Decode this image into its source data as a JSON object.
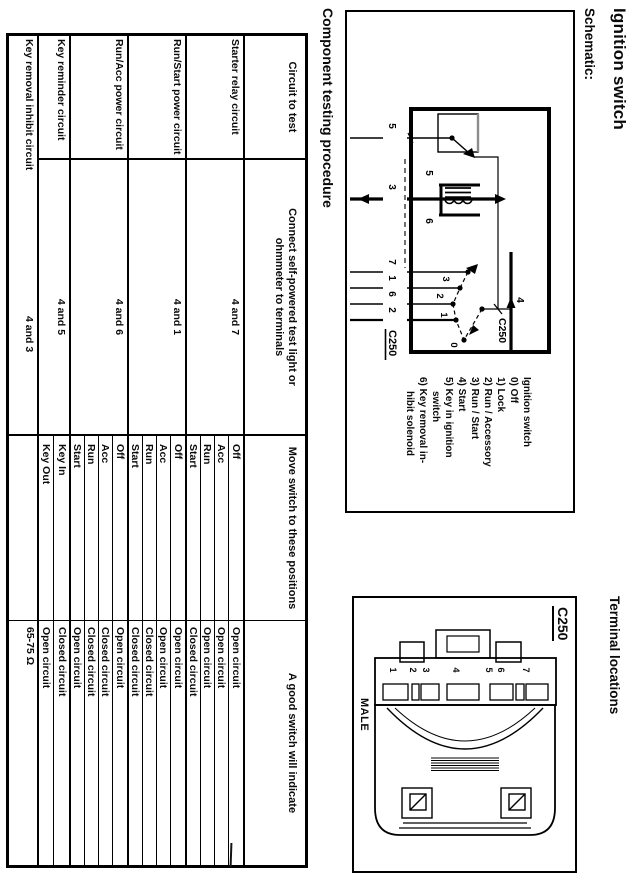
{
  "page": {
    "title": "Ignition switch",
    "schematic_label": "Schematic:",
    "terminal_locations_label": "Terminal locations",
    "component_testing_label": "Component testing procedure"
  },
  "schematic": {
    "connector": "C250",
    "terminals_bottom": [
      "5",
      "3",
      "7",
      "1",
      "6",
      "2"
    ],
    "terminal_feed": "4",
    "feed_connector": "C250",
    "component_key_in": "5",
    "component_solenoid": "6",
    "positions": [
      "0",
      "1",
      "2",
      "3"
    ],
    "legend": [
      {
        "text": "Ignition switch",
        "indent": false
      },
      {
        "text": "0) Off",
        "indent": false
      },
      {
        "text": "1) Lock",
        "indent": false
      },
      {
        "text": "2) Run / Accessory",
        "indent": false
      },
      {
        "text": "3) Run / Start",
        "indent": false
      },
      {
        "text": "4) Start",
        "indent": false
      },
      {
        "text": "5) Key in ignition",
        "indent": false
      },
      {
        "text": "switch",
        "indent": true
      },
      {
        "text": "6) Key removal in-",
        "indent": false
      },
      {
        "text": "hibit solenoid",
        "indent": true
      }
    ]
  },
  "terminal_panel": {
    "connector": "C250",
    "gender": "MALE",
    "pins_top_to_bottom": [
      "7",
      "6",
      "5",
      "4",
      "3",
      "2",
      "1"
    ]
  },
  "table": {
    "headers": {
      "circuit": "Circuit to test",
      "connect": "Connect self-powered test light or\nohmmeter to terminals",
      "move": "Move switch to these positions",
      "indicate": "A good switch will indicate"
    },
    "rows": [
      {
        "circuit": "Starter relay circuit",
        "terminals": "4 and 7",
        "merged": false,
        "tests": [
          [
            "Off",
            "Open circuit"
          ],
          [
            "Acc",
            "Open circuit"
          ],
          [
            "Run",
            "Open circuit"
          ],
          [
            "Start",
            "Closed circuit"
          ]
        ]
      },
      {
        "circuit": "Run/Start power circuit",
        "terminals": "4 and 1",
        "merged": false,
        "tests": [
          [
            "Off",
            "Open circuit"
          ],
          [
            "Acc",
            "Open circuit"
          ],
          [
            "Run",
            "Closed circuit"
          ],
          [
            "Start",
            "Closed circuit"
          ]
        ]
      },
      {
        "circuit": "Run/Acc power circuit",
        "terminals": "4 and 6",
        "merged": false,
        "tests": [
          [
            "Off",
            "Open circuit"
          ],
          [
            "Acc",
            "Closed circuit"
          ],
          [
            "Run",
            "Closed circuit"
          ],
          [
            "Start",
            "Open circuit"
          ]
        ]
      },
      {
        "circuit": "Key reminder circuit",
        "terminals": "4 and 5",
        "merged": false,
        "tests": [
          [
            "Key In",
            "Closed circuit"
          ],
          [
            "Key Out",
            "Open circuit"
          ]
        ]
      },
      {
        "circuit": "Key removal inhibit circuit",
        "terminals": "4 and 3",
        "merged": true,
        "tests": [
          [
            "",
            "65-75 Ω"
          ]
        ]
      }
    ]
  }
}
